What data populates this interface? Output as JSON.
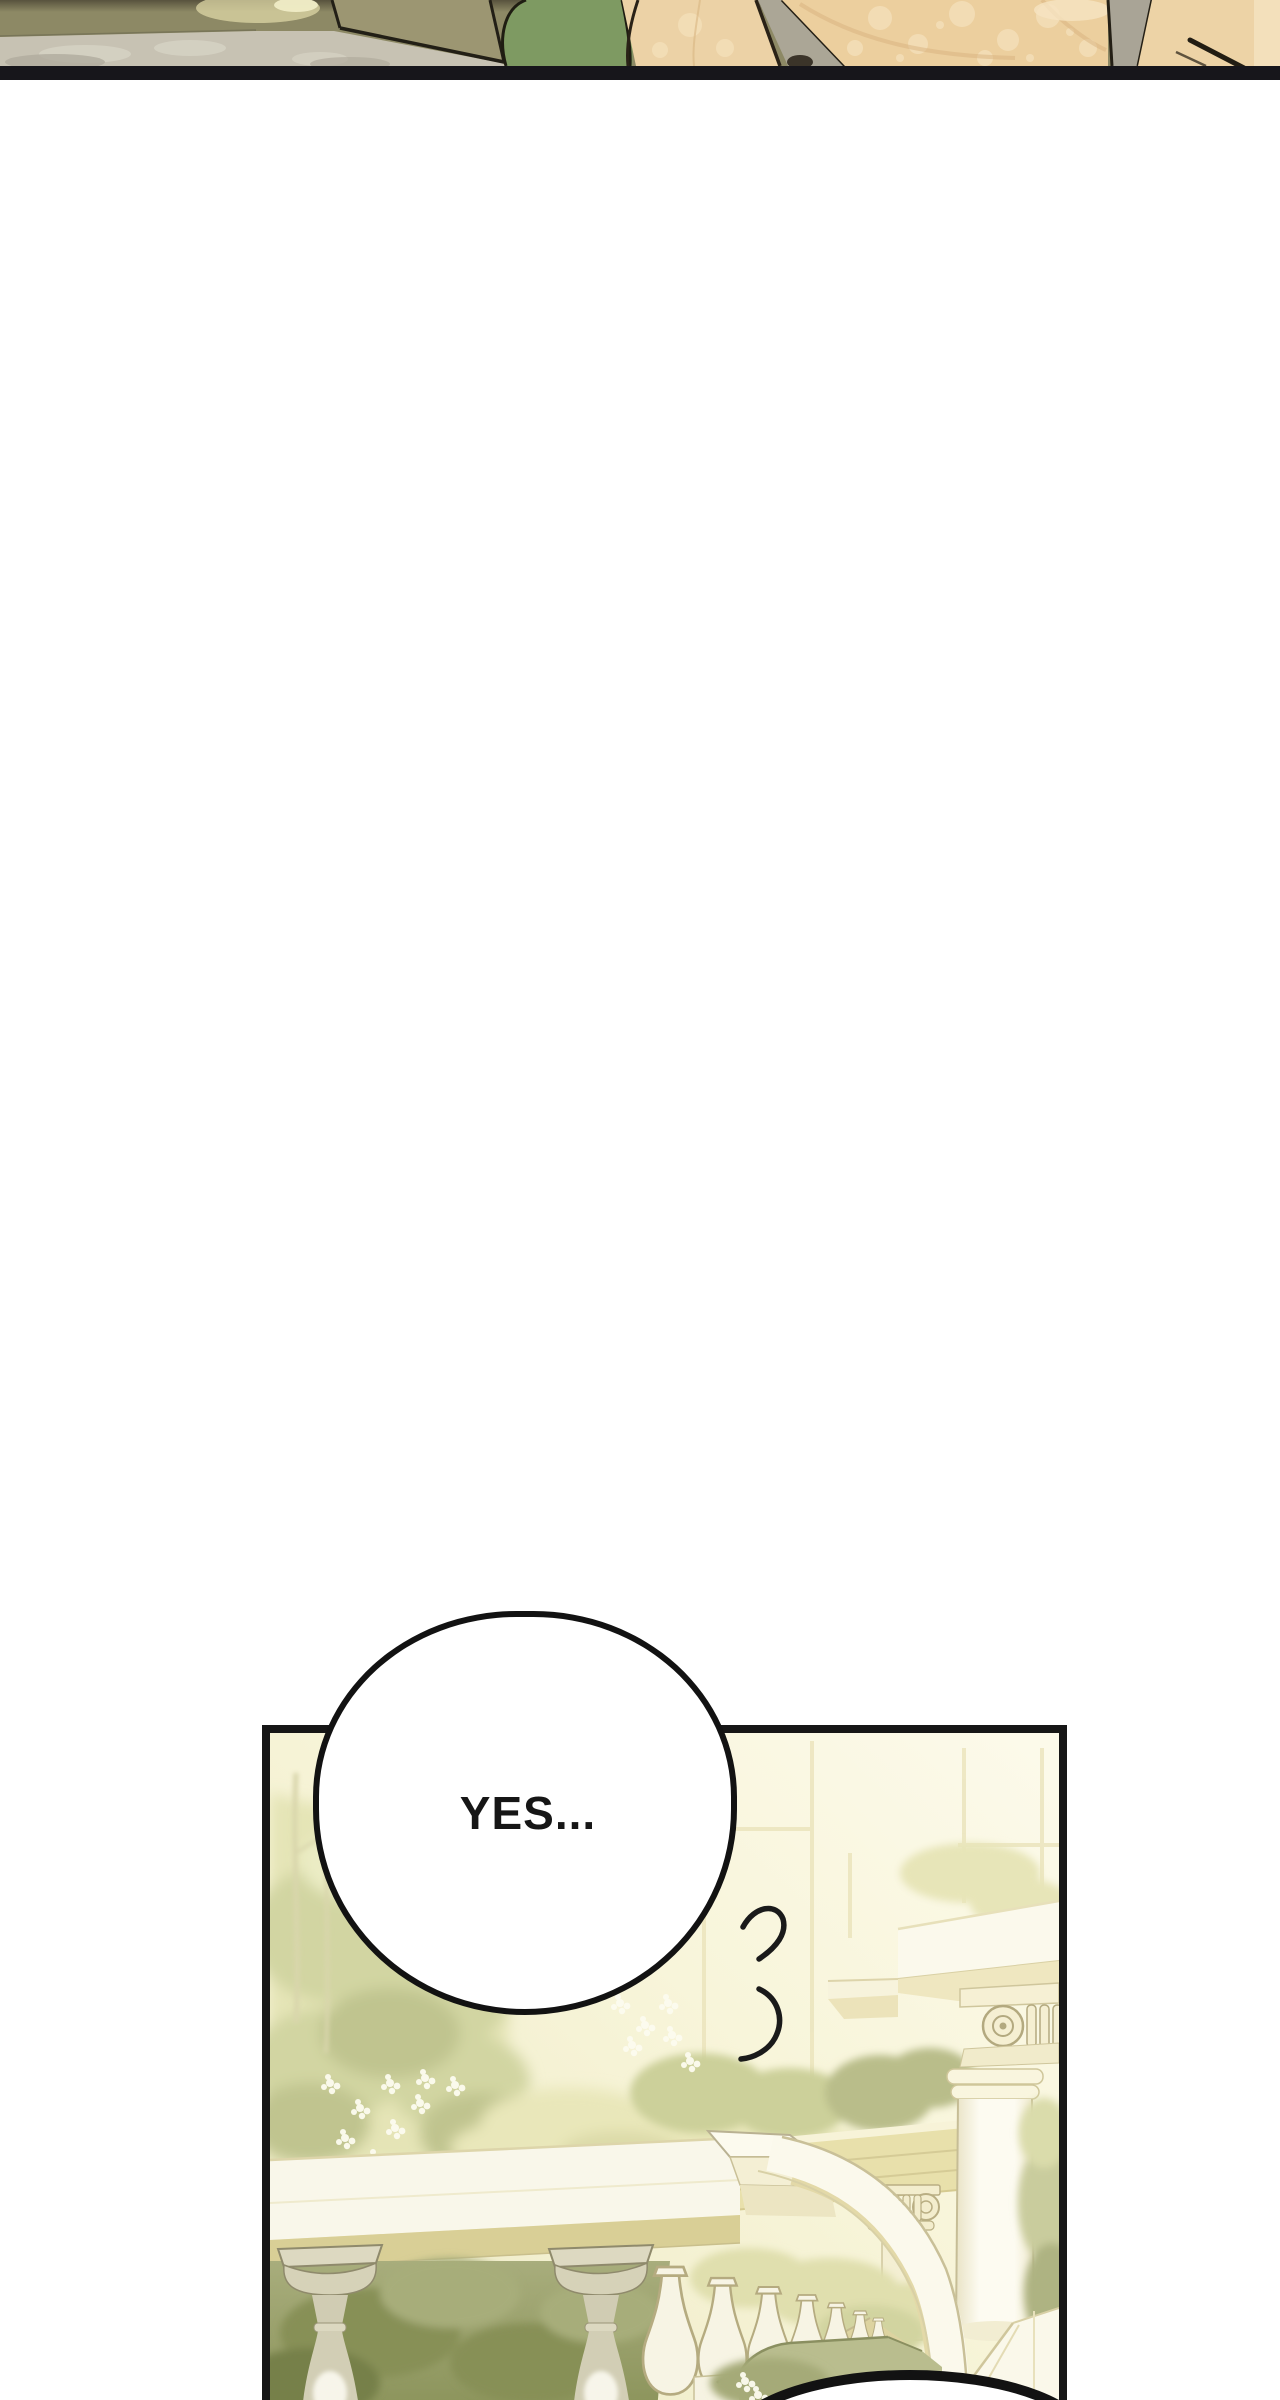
{
  "page": {
    "width": 1280,
    "height": 2400,
    "background_color": "#ffffff"
  },
  "previous_panel_strip": {
    "position": "top-edge sliver of previous comic panel",
    "height_px": 80,
    "bottom_border_color": "#17161b",
    "palette": {
      "olive_wall": "#8d8965",
      "olive_top_shadow": "#464030",
      "shine_highlight": "#f2eec9",
      "table_gray": "#c7c2b3",
      "khaki_object": "#9c9672",
      "green_garment": "#7e9a62",
      "fabric_tan": "#eccf9e",
      "fabric_floral_pattern": "#f5e1bc",
      "fabric_fold_shadow": "#d7b17e",
      "hair_strand_gray": "#aba696",
      "ink_outline": "#241f15"
    }
  },
  "gutter": {
    "background_color": "#ffffff"
  },
  "main_panel": {
    "description": "palace terrace: trees with white flowers, stone balustrade with balusters, curved stair railing, ionic column and cornice, hedge",
    "border_color": "#161616",
    "border_width_px": 8,
    "palette": {
      "wall_cream": "#f8f5da",
      "wall_bright": "#fcfaeb",
      "wall_frame_line": "#e9e2b8",
      "foliage_pale": "#e3e3b4",
      "foliage_light": "#d2d5a2",
      "foliage_mid": "#c0c48f",
      "foliage_dark": "#9aa171",
      "foliage_deep": "#879056",
      "flower_white": "#fdfcf0",
      "stone_white": "#fbf9ec",
      "stone_cream": "#f1ecca",
      "stone_tan": "#d9cf96",
      "stone_line": "#b3a97f",
      "beam_tan": "#e8e0ab",
      "baluster_gray": "#d6d2b8",
      "hedge_green": "#b9bd8e",
      "hedge_line": "#8a8f60"
    }
  },
  "speech_bubble": {
    "text": "YES...",
    "fill": "#ffffff",
    "outline_color": "#121212",
    "outline_width_px": 6,
    "text_color": "#161616"
  },
  "breath_marks": {
    "shape": "two short curved ink strokes",
    "color": "#1a1a1a",
    "count": 2
  },
  "bottom_partial_bubble": {
    "fill": "#ffffff",
    "outline_color": "#121212",
    "visible_part": "top arc at panel bottom edge"
  }
}
